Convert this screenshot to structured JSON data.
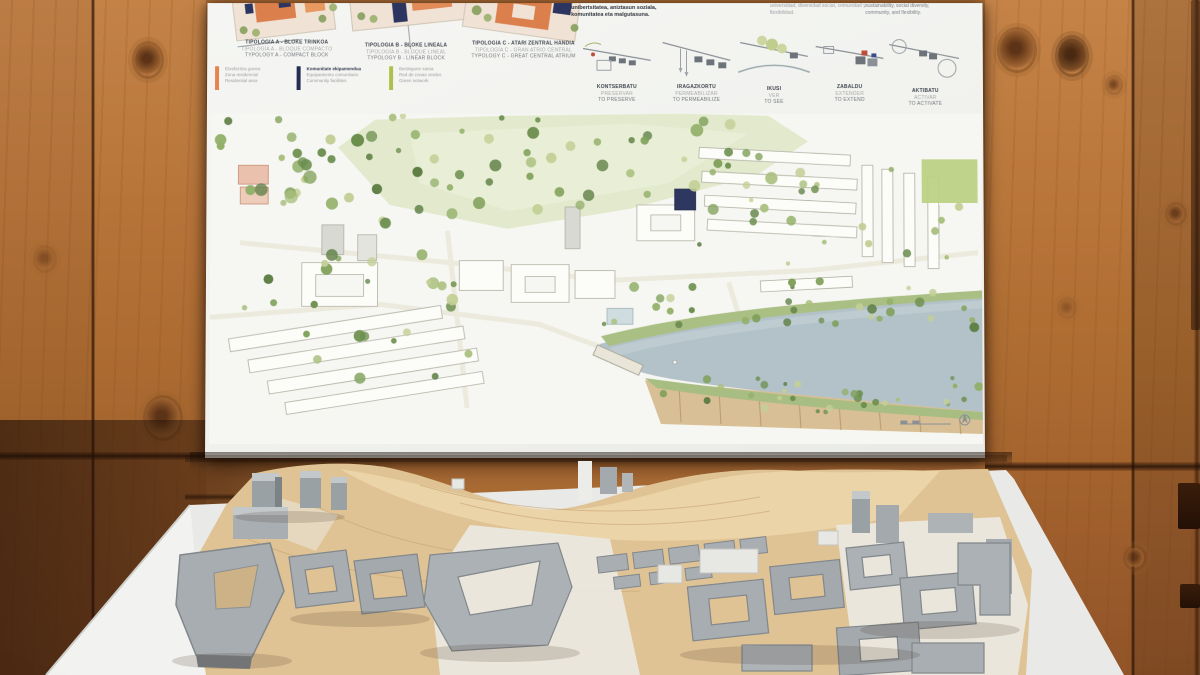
{
  "photo": {
    "subject": "Urban masterplan competition poster mounted on a wooden wall above a grey 3D architectural site model on a plywood base"
  },
  "poster": {
    "intro": {
      "col1_line1": "unibertsitatea, aniztasun soziala,",
      "col1_line2": "komunitatea eta malgutasuna.",
      "col2_line1": "universidad, diversidad social, comunidad y",
      "col2_line2": "flexibilidad.",
      "col3_line1": "sustainability, social diversity,",
      "col3_line2": "community, and flexibility."
    },
    "typologies": [
      {
        "eu": "TIPOLOGIA A - BLOKE TRINKOA",
        "es": "TIPOLOGÍA A - BLOQUE COMPACTO",
        "en": "TYPOLOGY A - COMPACT BLOCK"
      },
      {
        "eu": "TIPOLOGIA B - BLOKE LINEALA",
        "es": "TIPOLOGÍA B - BLOQUE LINEAL",
        "en": "TYPOLOGY B - LINEAR BLOCK"
      },
      {
        "eu": "TIPOLOGIA C - ATARI ZENTRAL HANDIA",
        "es": "TIPOLOGÍA C - GRAN ATRIO CENTRAL",
        "en": "TYPOLOGY C - GREAT CENTRAL ATRIUM"
      }
    ],
    "legend": [
      {
        "color": "#e8834e",
        "l1": "Etxebizitza gunea",
        "l2": "Zona residencial",
        "l3": "Residential area"
      },
      {
        "color": "#242c55",
        "l1": "Komunitate ekipamendua",
        "l2": "Equipamiento comunitario",
        "l3": "Community facilities"
      },
      {
        "color": "#aebf4e",
        "l1": "Berdegune sarea",
        "l2": "Red de zonas verdes",
        "l3": "Green network"
      }
    ],
    "strategies": [
      {
        "eu": "KONTSERBATU",
        "es": "PRESERVAR",
        "en": "TO PRESERVE"
      },
      {
        "eu": "IRAGAZKORTU",
        "es": "PERMEABILIZAR",
        "en": "TO PERMEABILIZE"
      },
      {
        "eu": "IKUSI",
        "es": "VER",
        "en": "TO SEE"
      },
      {
        "eu": "ZABALDU",
        "es": "EXTENDER",
        "en": "TO EXTEND"
      },
      {
        "eu": "AKTIBATU",
        "es": "ACTIVAR",
        "en": "TO ACTIVATE"
      }
    ],
    "axo_caption": {
      "eu": "AXONOMETRIA - PLAZA-BASO BERRIA",
      "es": "AXONOMETRÍA - LA NUEVA PLAZA-BOSQUE",
      "en": "AXONOMETRIC - THE NEW FOREST SQUARE"
    }
  },
  "colors": {
    "wall_wood": "#ab6c34",
    "poster_paper": "#f2f3ef",
    "plan_meadow": "#e2e9cd",
    "plan_river": "#b2c2c8",
    "plan_embankment": "#d9bf96",
    "model_base_wood": "#e0c394",
    "model_building_grey": "#a3a9ac",
    "model_table_white": "#e9e9e7"
  }
}
